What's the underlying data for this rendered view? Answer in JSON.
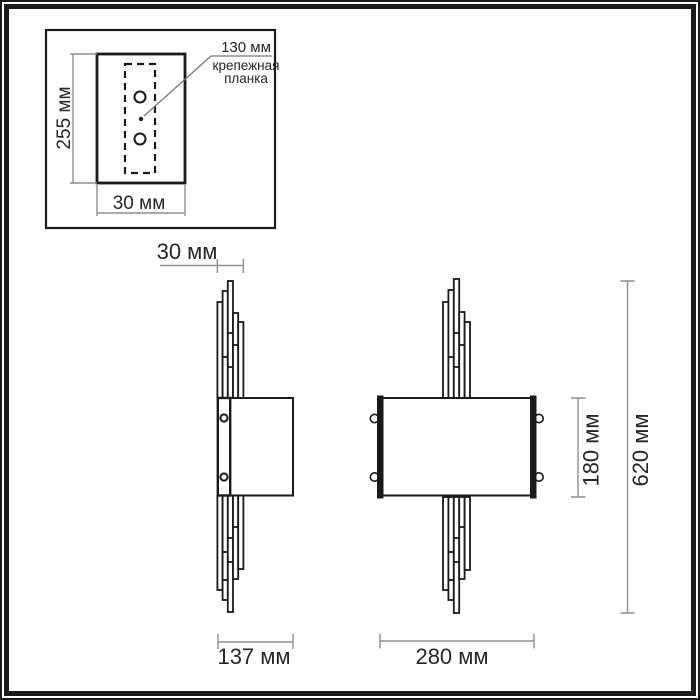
{
  "drawing": {
    "inset": {
      "height_label": "255 мм",
      "width_label": "30 мм",
      "offset_label": "130 мм",
      "plate_caption_line1": "крепежная",
      "plate_caption_line2": "планка"
    },
    "side_view": {
      "rod_width_label": "30 мм",
      "depth_label": "137 мм"
    },
    "front_view": {
      "width_label": "280 мм",
      "shade_height_label": "180 мм",
      "total_height_label": "620 мм"
    },
    "colors": {
      "object_line": "#1a1a1a",
      "dimension_line": "#8f8f8f",
      "label_text": "#262626",
      "frame": "#1b1b1b",
      "background": "#ffffff"
    }
  }
}
